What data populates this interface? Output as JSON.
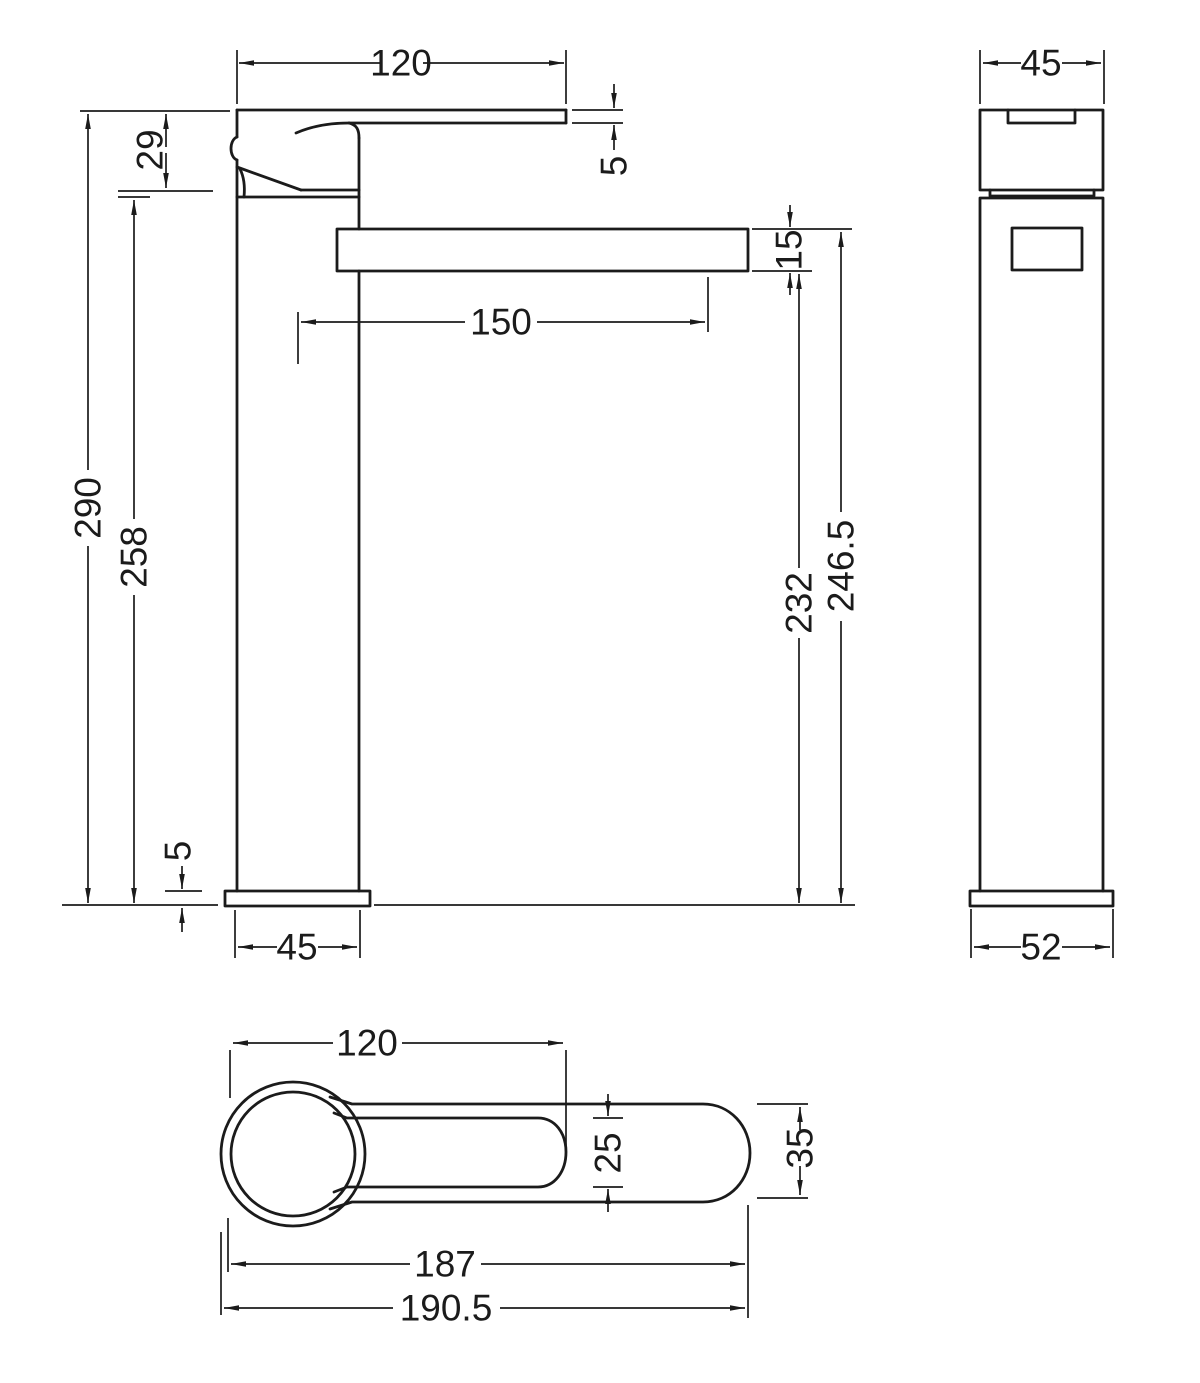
{
  "title": "Tall basin mixer tap dimensioned technical drawing",
  "colors": {
    "line": "#1b1b1b",
    "background": "#ffffff"
  },
  "views": {
    "front": {
      "label": "front elevation",
      "dims": {
        "lever_length": "120",
        "lever_thickness": "5",
        "handle_height": "29",
        "overall_height": "290",
        "body_height": "258",
        "spout_reach": "150",
        "spout_thickness": "15",
        "spout_bottom_height": "232",
        "spout_top_height": "246.5",
        "base_thickness": "5",
        "base_width": "45"
      }
    },
    "side": {
      "label": "side elevation",
      "dims": {
        "width": "45",
        "base_width": "52"
      }
    },
    "plan": {
      "label": "plan view",
      "dims": {
        "lever_length": "120",
        "lever_width": "25",
        "spout_width": "35",
        "body_length": "187",
        "overall_length": "190.5"
      }
    }
  }
}
